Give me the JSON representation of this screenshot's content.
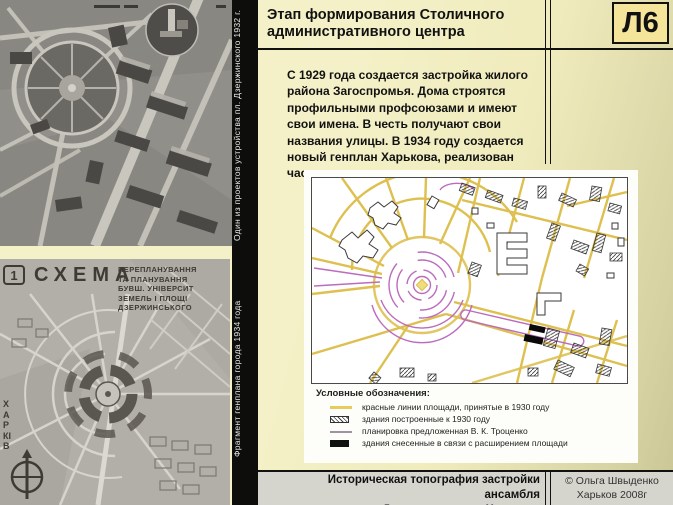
{
  "slide": {
    "code": "Л6",
    "title": "Этап формирования Столичного\nадминистративного центра",
    "paragraph": "С 1929 года создается застройка жилого района Загоспромья. Дома строятся профильными профсоюзами и имеют свои имена. В честь получают свои названия улицы. В 1934 году создается новый генплан Харькова, реализован частично.",
    "footer_title": "Историческая топография застройки ансамбля\nпл. Дзержинского в г. Харькове",
    "credit": "© Ольга Швыденко\nХарьков 2008г"
  },
  "left_captions": {
    "top": "Один из проектов устройства пл. Дзержинского 1932 г.",
    "bottom": "Фрагмент генплана города 1934 года"
  },
  "schema_image": {
    "index": "1",
    "title": "СХЕМА",
    "subtitle_lines": [
      "ПЕРЕПЛАНУВАННЯ",
      "ТА ПЛАНУВАННЯ",
      "БУВШ. УНІВЕРСИТ",
      "ЗЕМЕЛЬ І ПЛОЩІ",
      "ДЗЕРЖИНСЬКОГО"
    ],
    "side_label": "ХАРКІВ"
  },
  "legend": {
    "title": "Условные обозначения:",
    "items": [
      {
        "swatch": "yellow-line",
        "label": "красные линии площади, принятые в 1930 году"
      },
      {
        "swatch": "hatched-building",
        "label": "здания построенные к 1930 году"
      },
      {
        "swatch": "gray-line",
        "label": "планировка предложенная В. К. Троценко"
      },
      {
        "swatch": "black-building",
        "label": "здания снесенные в связи с расширением площади"
      }
    ]
  },
  "colors": {
    "background": "#F2EFC4",
    "background_dark_edge": "#C9C595",
    "code_box_fill": "#F5E59B",
    "footer_bar": "#D5D5CD",
    "map_street_yellow": "#DEC050",
    "map_plan_magenta": "#BC6CBC",
    "strip_black": "#0d0d0c"
  }
}
